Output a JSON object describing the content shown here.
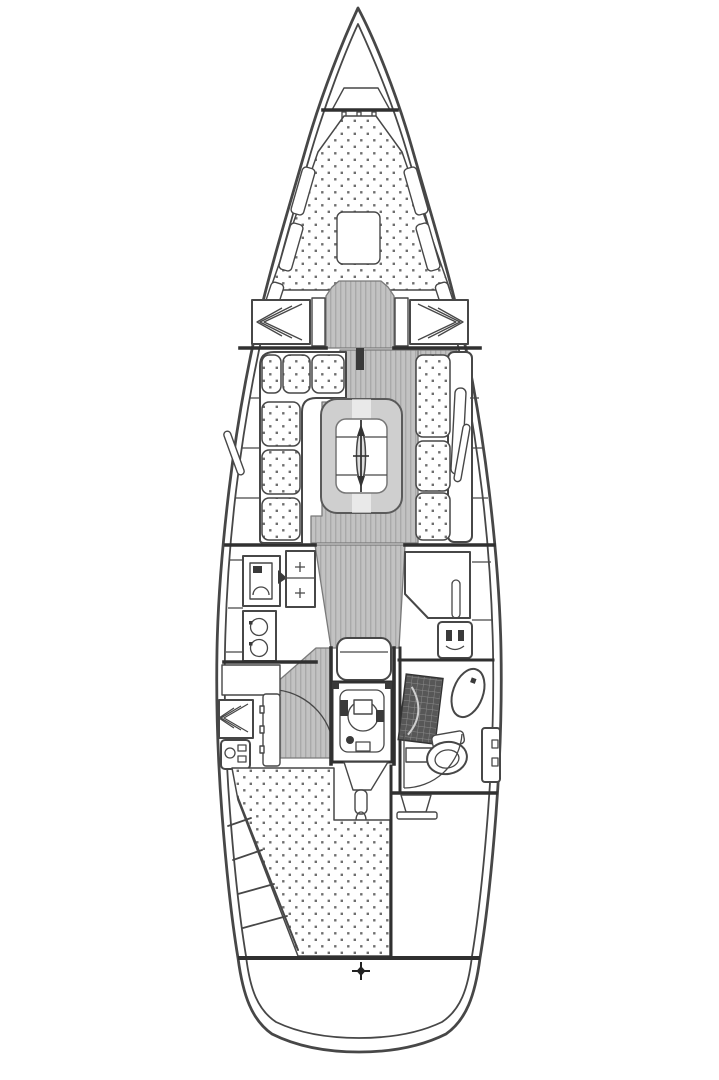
{
  "diagram": {
    "type": "sailboat-interior-floor-plan",
    "orientation": "bow-up",
    "colors": {
      "bg": "#ffffff",
      "line": "#474747",
      "heavy": "#303030",
      "sole": "#c2c2c2",
      "stripe": "#a9a9a9",
      "dot": "#4a4a4a",
      "engine": "#3a3a3a",
      "grate": "#575757"
    },
    "areas": [
      {
        "name": "anchor-locker"
      },
      {
        "name": "v-berth-forward-cabin"
      },
      {
        "name": "forward-hanging-lockers"
      },
      {
        "name": "saloon-port-settee"
      },
      {
        "name": "saloon-starboard-settee"
      },
      {
        "name": "saloon-table"
      },
      {
        "name": "mast-symbol"
      },
      {
        "name": "galley"
      },
      {
        "name": "nav-station"
      },
      {
        "name": "companionway-steps"
      },
      {
        "name": "engine-compartment"
      },
      {
        "name": "aft-cabin-berth"
      },
      {
        "name": "head-bathroom"
      },
      {
        "name": "lazarette"
      },
      {
        "name": "transom-mark"
      }
    ]
  }
}
